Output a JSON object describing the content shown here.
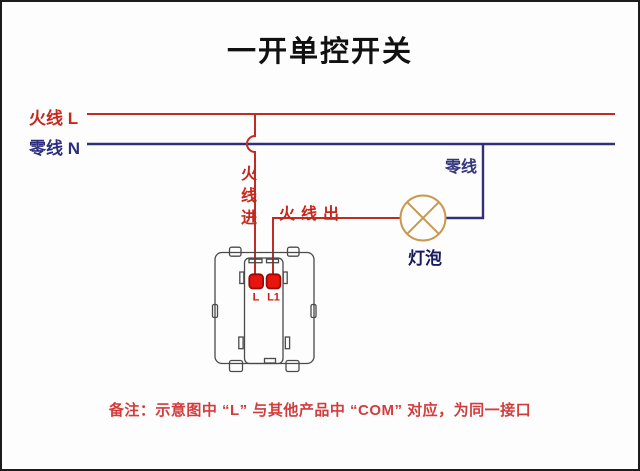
{
  "title": "一开单控开关",
  "labels": {
    "live_wire": "火线 L",
    "neutral_wire": "零线 N",
    "live_in": "火线进",
    "live_out": "火线出",
    "neutral_branch": "零线",
    "bulb": "灯泡",
    "terminal_l": "L",
    "terminal_l1": "L1"
  },
  "note": "备注：示意图中 “L” 与其他产品中 “COM” 对应，为同一接口",
  "colors": {
    "live_wire_red": "#c02b24",
    "neutral_wire_blue": "#30307a",
    "live_label_red": "#c5281c",
    "neutral_label_blue": "#2d2d7f",
    "neutral_branch_blue": "#35357e",
    "bulb_label_navy": "#1b1b60",
    "bulb_outline_tan": "#c9984f",
    "terminal_fill_red": "#e8140e",
    "terminal_border_darkred": "#990b06",
    "switch_outline_gray": "#4a4a4a",
    "note_red": "#d23c3c",
    "title_black": "#111111",
    "background": "#fdfdfd"
  }
}
